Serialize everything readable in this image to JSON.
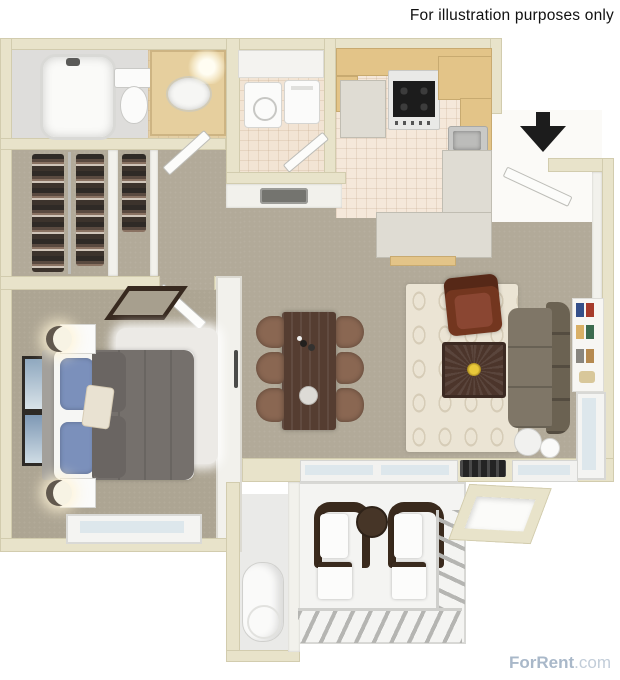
{
  "meta": {
    "disclaimer": "For illustration purposes only",
    "watermark_brand": "ForRent",
    "watermark_suffix": ".com"
  },
  "icons": {
    "entry_arrow": "black solid arrow pointing down at apartment entry door"
  },
  "colors": {
    "text": "#111111",
    "watermark": "#a9b8c9",
    "watermark_light": "#c2cdd9",
    "wall": "#e8e3ca",
    "wall_edge": "#d2ccae",
    "wall_face": "#f2f1ec",
    "carpet": "#b2aa99",
    "carpet_bedroom": "#ada593",
    "tile_kitchen": "#f5e8da",
    "tile_bath": "#e4d0a6",
    "tile_laundry": "#f2e4d4",
    "entry_floor": "#fbfaf7",
    "storage_floor": "#eaeae8",
    "patio_floor": "#f4f4f2",
    "wood": "#e3c488",
    "counter": "#dfdcd3",
    "table_wood": "#553d31",
    "chair_brown": "#8a6752",
    "rug_cream": "#ebe4d4",
    "rug_pattern": "#d6ccb7",
    "armchair": "#73361f",
    "sofa_seat": "#7f7667",
    "sofa_back": "#6b6252",
    "bed_comforter": "#75706c",
    "pillow_blue": "#7b90bb",
    "shag": "#eceae6",
    "patio_wood": "#3a2a1d",
    "glass": "#dde7ec",
    "black": "#1c1c1c",
    "steel": "#c9c9c7",
    "vent": "#74746f"
  }
}
